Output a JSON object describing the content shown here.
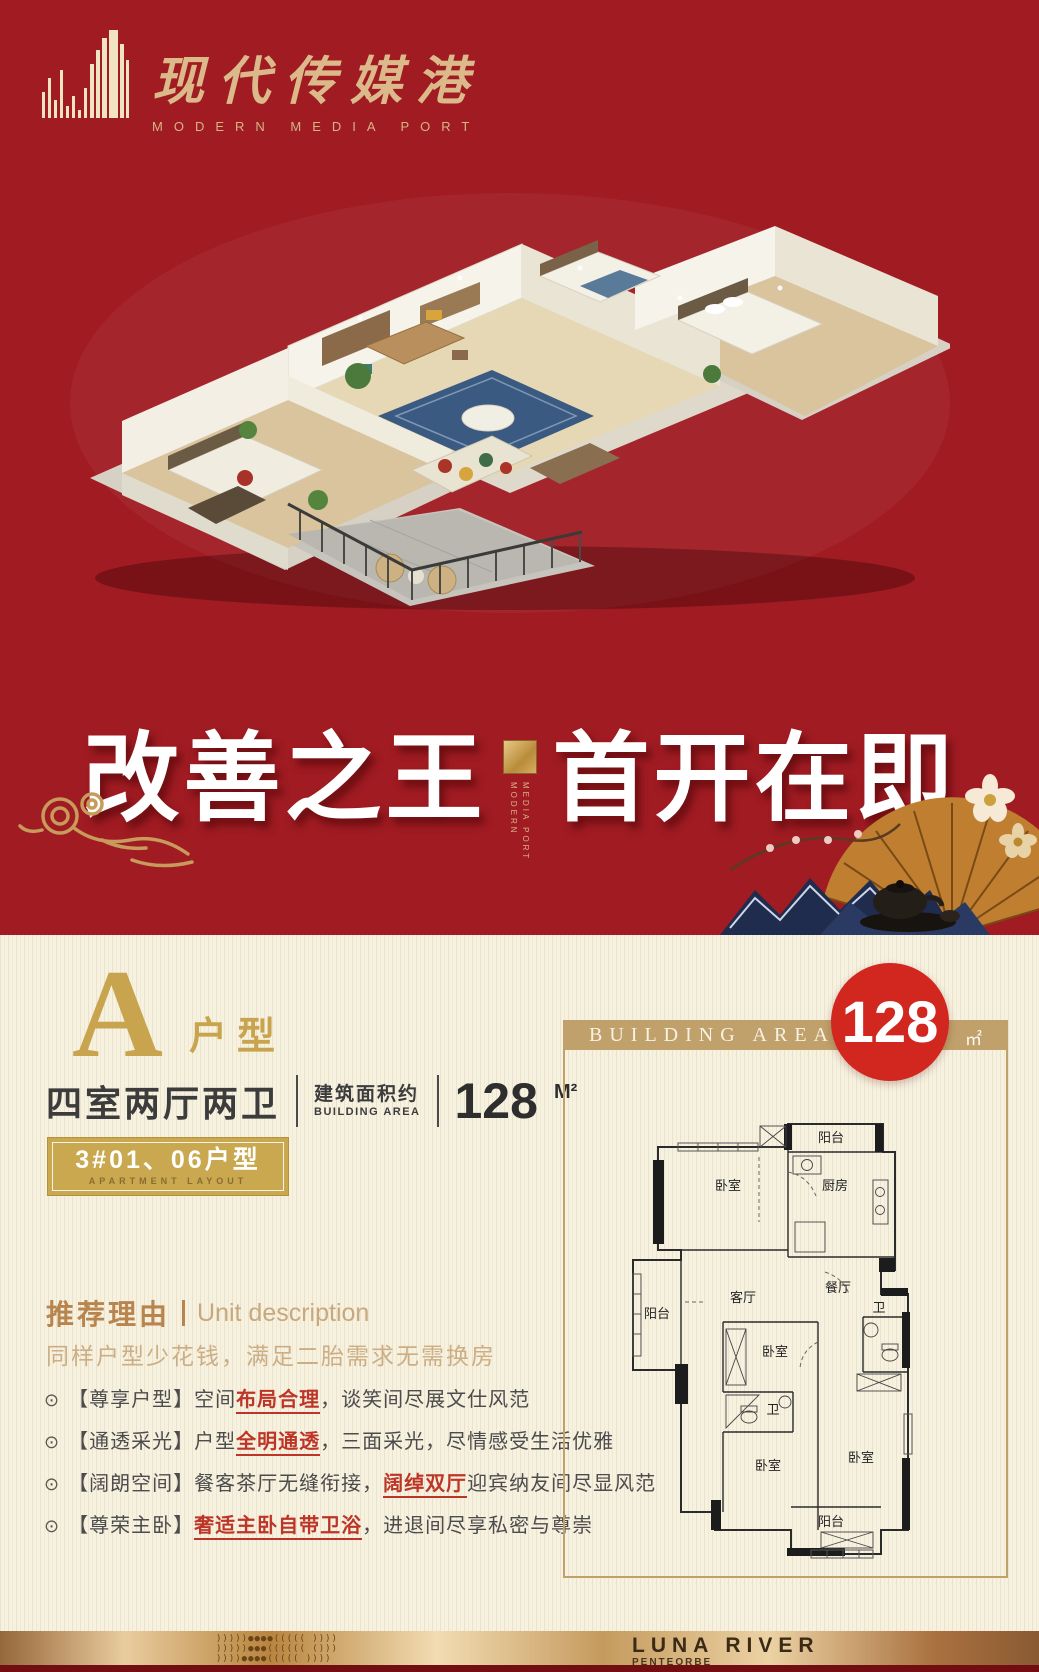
{
  "brand": {
    "name_cn": "现代传媒港",
    "name_en": "MODERN MEDIA PORT"
  },
  "headline": {
    "left": "改善之王",
    "right": "首开在即",
    "divider_line1": "MODERN",
    "divider_line2": "MEDIA PORT"
  },
  "unit": {
    "type_letter": "A",
    "type_label": "户型",
    "rooms": "四室两厅两卫",
    "area_label_cn": "建筑面积约",
    "area_label_en": "BUILDING AREA",
    "area_value": "128",
    "area_unit": "M²",
    "apartment_no": "3#01、06户型",
    "apartment_no_en": "APARTMENT LAYOUT"
  },
  "description": {
    "title_cn": "推荐理由",
    "title_en": "Unit description",
    "subtitle": "同样户型少花钱，满足二胎需求无需换房",
    "bullet_glyph": "⊙",
    "bullets": [
      {
        "tag": "【尊享户型】",
        "pre": "空间",
        "highlight": "布局合理",
        "post": "，谈笑间尽展文仕风范"
      },
      {
        "tag": "【通透采光】",
        "pre": "户型",
        "highlight": "全明通透",
        "post": "，三面采光，尽情感受生活优雅"
      },
      {
        "tag": "【阔朗空间】",
        "pre": "餐客茶厅无缝衔接，",
        "highlight": "阔绰双厅",
        "post": "迎宾纳友间尽显风范"
      },
      {
        "tag": "【尊荣主卧】",
        "pre": "",
        "highlight": "奢适主卧自带卫浴",
        "post": "，进退间尽享私密与尊崇"
      }
    ]
  },
  "floorplan": {
    "header": "BUILDING AREA",
    "badge_value": "128",
    "badge_unit": "㎡",
    "rooms": {
      "balcony_top": "阳台",
      "bedroom_top": "卧室",
      "kitchen": "厨房",
      "dining": "餐厅",
      "balcony_left": "阳台",
      "living": "客厅",
      "bedroom_mid": "卧室",
      "bath_right": "卫",
      "bath_left": "卫",
      "bedroom_bottom_left": "卧室",
      "bedroom_bottom_right": "卧室",
      "balcony_bottom": "阳台"
    }
  },
  "footer": {
    "brand": "LUNA RIVER",
    "sub": "PENTEORBE",
    "pattern_lines": [
      ")))))●●●●(((((  ))))",
      ")))))●●●((((((  ()))",
      "))))●●●●(((((  ))))"
    ]
  },
  "colors": {
    "hero_red": "#a01b22",
    "badge_red": "#d2271f",
    "gold": "#c8a44e",
    "bar_gold": "#c0a06b",
    "highlight_red": "#bd3527",
    "cream": "#f7f1e0"
  }
}
